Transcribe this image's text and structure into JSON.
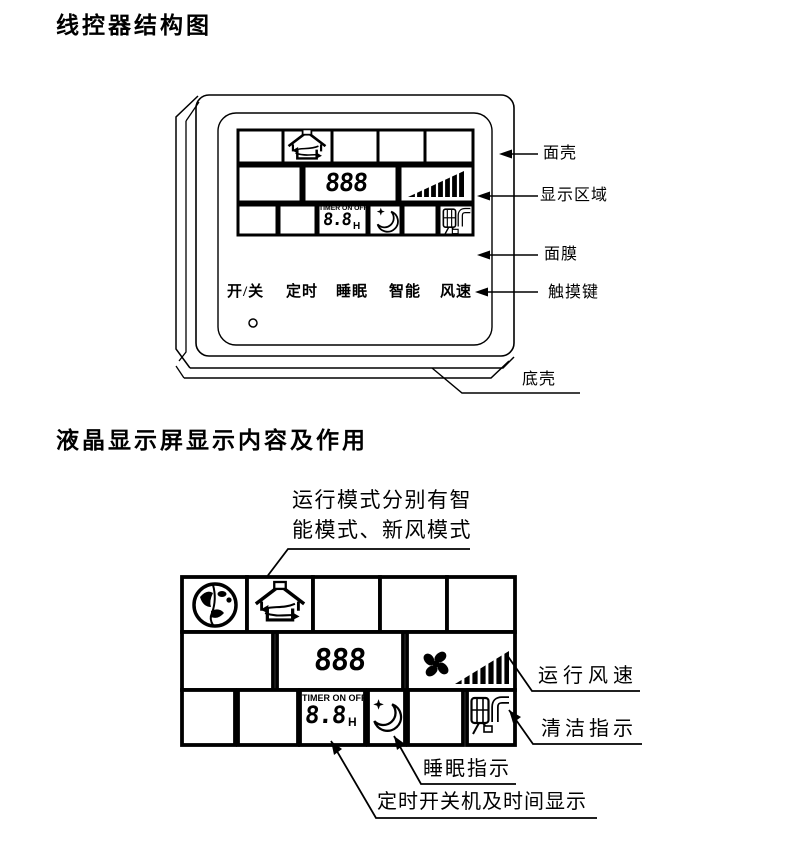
{
  "titles": {
    "section1": "线控器结构图",
    "section2": "液晶显示屏显示内容及作用"
  },
  "controller": {
    "buttons": [
      "开/关",
      "定时",
      "睡眠",
      "智能",
      "风速"
    ],
    "display": {
      "digits": "888",
      "timer_caption": "TIMER ON OFF",
      "timer_digits": "8.8",
      "timer_unit": "H"
    },
    "callouts": {
      "front_shell": "面壳",
      "display_area": "显示区域",
      "face_film": "面膜",
      "touch_keys": "触摸键",
      "bottom_shell": "底壳"
    }
  },
  "lcd_detail": {
    "mode_note": {
      "line1": "运行模式分别有智",
      "line2": "能模式、新风模式"
    },
    "display": {
      "digits": "888",
      "timer_caption": "TIMER ON OFF",
      "timer_digits": "8.8",
      "timer_unit": "H"
    },
    "callouts": {
      "fan_speed": "运行风速",
      "clean": "清洁指示",
      "sleep": "睡眠指示",
      "timer": "定时开关机及时间显示"
    }
  }
}
